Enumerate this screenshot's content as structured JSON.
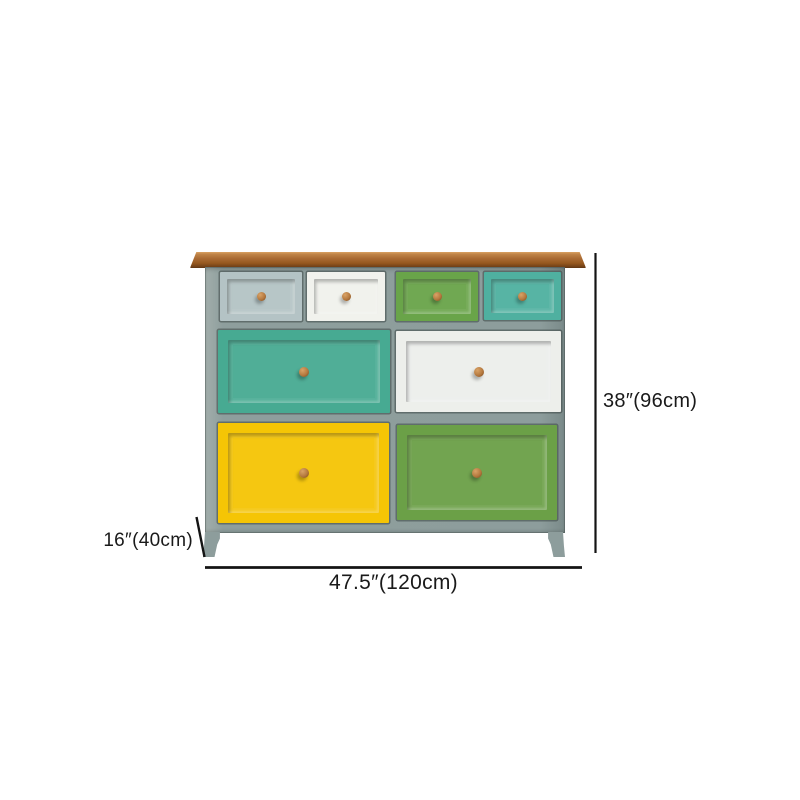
{
  "annotations": {
    "height_label": "38″(96cm)",
    "width_label": "47.5″(120cm)",
    "depth_label": "16″(40cm)",
    "line_color": "#141414"
  },
  "cabinet": {
    "description_colors": {
      "wood_top": "#a96a33",
      "frame": "#8d9d9c",
      "knob": "#b5793f"
    },
    "drawers": [
      {
        "name": "top-row-drawer-1",
        "color": "#b4c3c5"
      },
      {
        "name": "top-row-drawer-2",
        "color": "#f1f2ed"
      },
      {
        "name": "top-row-drawer-3",
        "color": "#69a449"
      },
      {
        "name": "top-row-drawer-4",
        "color": "#4fb0a0"
      },
      {
        "name": "middle-row-drawer-left",
        "color": "#47aa92"
      },
      {
        "name": "middle-row-drawer-right",
        "color": "#edefeb"
      },
      {
        "name": "bottom-row-drawer-left",
        "color": "#f5c505"
      },
      {
        "name": "bottom-row-drawer-right",
        "color": "#6ba047"
      }
    ]
  }
}
